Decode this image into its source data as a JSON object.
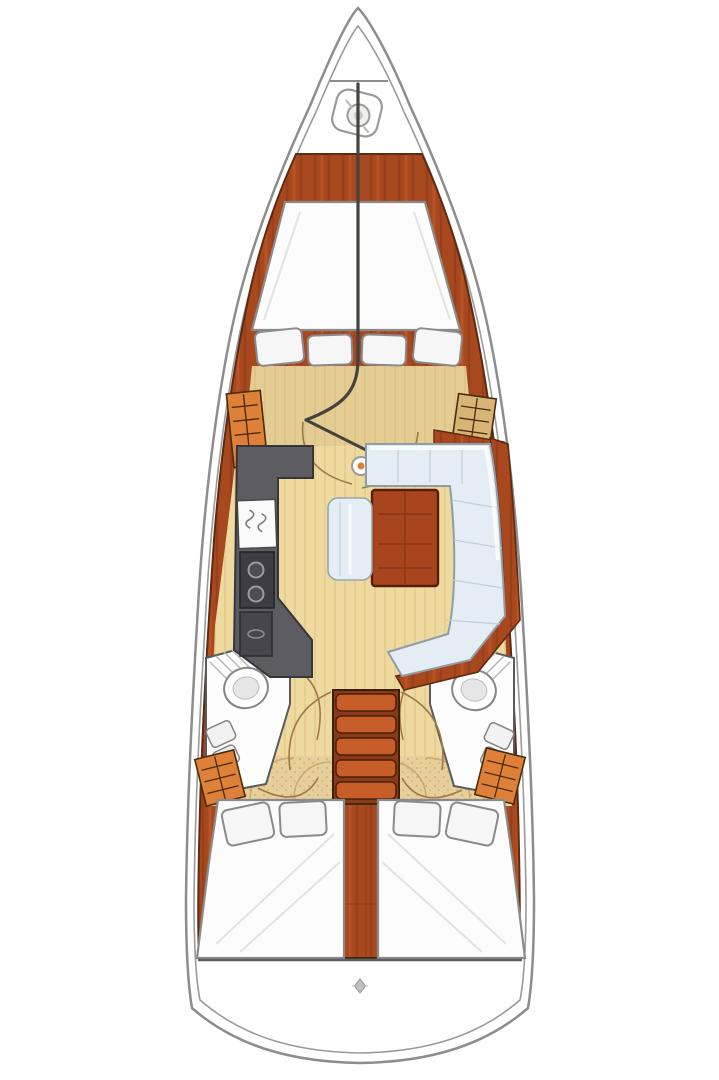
{
  "meta": {
    "title": "Sailboat interior layout floor plan",
    "view": "top-down deck plan, bow up",
    "visible_text": "none"
  },
  "rooms": {
    "anchor_locker": "Anchor locker with windlass at bow",
    "forward_cabin": "Forward cabin with V-berth and four pillows",
    "wardrobe_port": "Forward port wardrobe with shelves",
    "wardrobe_starboard": "Forward starboard wardrobe with shelves",
    "salon": "Salon walkway",
    "galley": "Port L-shaped galley with double sink, two-burner stove and oven",
    "dinette": "Starboard dinette with L-settee, wood table and side bench",
    "mast": "Mast compression post",
    "head_port": "Port aft head with toilet, basin and shower",
    "head_starboard": "Starboard aft head with toilet, basin and shower",
    "companionway": "Companionway stairs with five treads",
    "engine_compartment": "Engine compartment between aft cabins",
    "aft_cabin_port": "Port aft cabin with double berth and two pillows",
    "aft_cabin_starboard": "Starboard aft cabin with double berth and two pillows",
    "transom": "Rounded transom / swim platform"
  },
  "icons": {
    "windlass": "anchor-windlass-icon",
    "mast": "mast-post-icon",
    "transom_marker": "transom-fitting-icon"
  },
  "counts": {
    "forward_berth_pillows": 4,
    "aft_berth_pillows_each": 2,
    "stair_treads": 5,
    "stove_burners": 2,
    "heads": 2,
    "cabins": 3
  },
  "palette": {
    "white": "#ffffff",
    "hull_outline": "#8d8d8d",
    "inner_line": "#9a9a9a",
    "wood_base": "#a8481f",
    "wood_streak": "#7e3413",
    "wood_light": "#c9622e",
    "wood_edge": "#5f2a10",
    "locker_orange": "#de8038",
    "locker_tan": "#d9b477",
    "locker_line": "#4a2c0c",
    "floor_salon": "#eeda9f",
    "floor_plank_line": "#d8bc7d",
    "floor_fwd": "#e4cc92",
    "floor_fwd_line": "#d0b67c",
    "floor_aft": "#e6cf9a",
    "floor_aft_dot": "#c4a468",
    "galley_gray": "#5c5c62",
    "appliance_dark": "#3d3d43",
    "oven_dark": "#46464c",
    "settee_blue": "#e4edf4",
    "settee_line": "#c3ced6",
    "table_wood": "#a8441e",
    "stairs_base": "#8a3a16",
    "stair_tread": "#c75d28",
    "bed_white": "#fcfcfc",
    "bed_outline": "#8a8a8a",
    "pillow_white": "#f6f6f6",
    "fixture_outline": "#858585",
    "arc_brown": "#9c7a4a",
    "dark_seam": "#44443e"
  }
}
